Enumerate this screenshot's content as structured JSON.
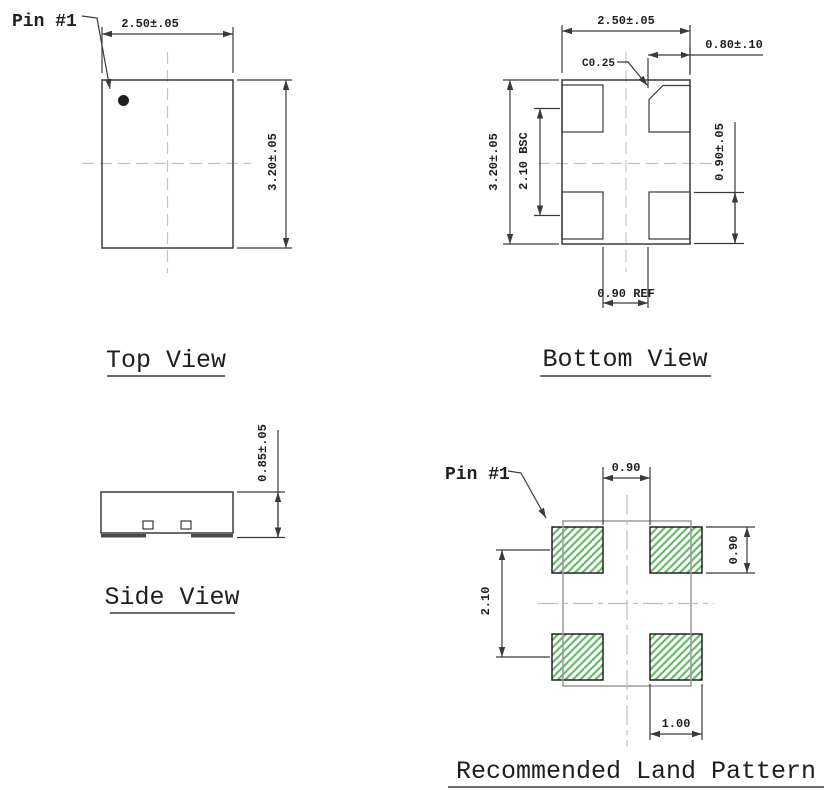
{
  "drawing": {
    "views": {
      "top": {
        "label": "Top View",
        "pin1": "Pin #1",
        "dim_width": "2.50±.05",
        "dim_height": "3.20±.05"
      },
      "bottom": {
        "label": "Bottom View",
        "dim_width": "2.50±.05",
        "dim_height": "3.20±.05",
        "dim_pad_pitch": "2.10 BSC",
        "dim_pad_width": "0.80±.10",
        "dim_pad_height": "0.90±.05",
        "dim_chamfer": "C0.25",
        "dim_pad_gap": "0.90 REF"
      },
      "side": {
        "label": "Side View",
        "dim_height": "0.85±.05"
      },
      "land": {
        "label": "Recommended Land Pattern",
        "pin1": "Pin #1",
        "dim_gap_x": "0.90",
        "dim_pad_height": "0.90",
        "dim_pitch_y": "2.10",
        "dim_pad_width": "1.00"
      }
    },
    "colors": {
      "line": "#3a3a3a",
      "centerline": "#c4c4c4",
      "package_outline_gray": "#9a9a9a",
      "pad_hatch_green": "#66bb6a",
      "background": "#ffffff"
    }
  }
}
